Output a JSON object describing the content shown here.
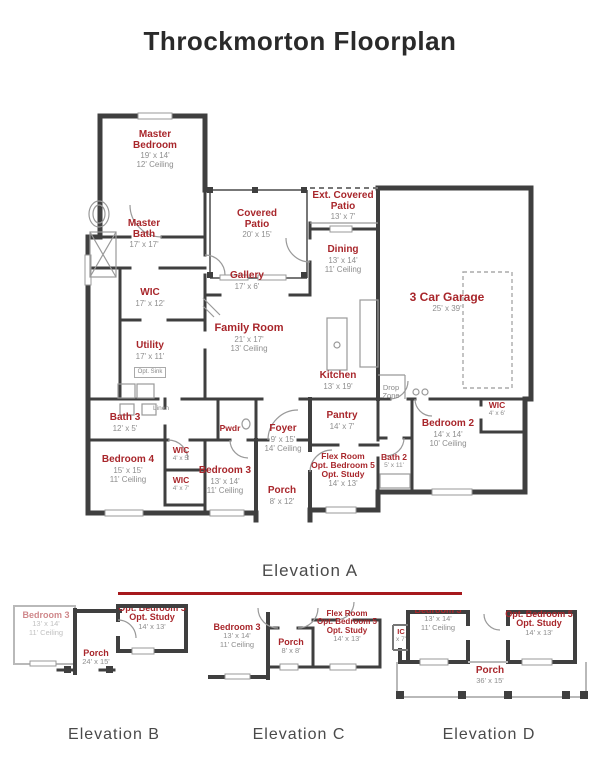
{
  "title": "Throckmorton Floorplan",
  "colors": {
    "room_label": "#a8262b",
    "dim_text": "#8e8e8e",
    "wall": "#3f3f3f",
    "divider_line": "#a6181c"
  },
  "main_plan": {
    "caption": "Elevation A",
    "rooms": {
      "master_bedroom": {
        "name": "Master Bedroom",
        "dims": "19' x 14'",
        "ceiling": "12' Ceiling"
      },
      "master_bath": {
        "name": "Master Bath",
        "dims": "17' x 17'"
      },
      "covered_patio": {
        "name": "Covered Patio",
        "dims": "20' x 15'"
      },
      "ext_covered_patio": {
        "name": "Ext. Covered Patio",
        "dims": "13' x 7'"
      },
      "dining": {
        "name": "Dining",
        "dims": "13' x 14'",
        "ceiling": "11' Ceiling"
      },
      "garage": {
        "name": "3 Car Garage",
        "dims": "25' x 39'"
      },
      "gallery": {
        "name": "Gallery",
        "dims": "17' x 6'"
      },
      "wic_master": {
        "name": "WIC",
        "dims": "17' x 12'"
      },
      "family_room": {
        "name": "Family Room",
        "dims": "21' x 17'",
        "ceiling": "13' Ceiling"
      },
      "utility": {
        "name": "Utility",
        "dims": "17' x 11'",
        "note": "Opt. Sink"
      },
      "kitchen": {
        "name": "Kitchen",
        "dims": "13' x 19'"
      },
      "drop_zone": {
        "name": "Drop Zone"
      },
      "pantry": {
        "name": "Pantry",
        "dims": "14' x 7'"
      },
      "bath_3": {
        "name": "Bath 3",
        "dims": "12' x 5'"
      },
      "pwdr": {
        "name": "Pwdr"
      },
      "foyer": {
        "name": "Foyer",
        "dims": "9' x 15'",
        "ceiling": "14' Ceiling"
      },
      "bedroom_2": {
        "name": "Bedroom 2",
        "dims": "14' x 14'",
        "ceiling": "10' Ceiling"
      },
      "wic_bedroom_2": {
        "name": "WIC",
        "dims": "4' x 6'"
      },
      "bedroom_4": {
        "name": "Bedroom 4",
        "dims": "15' x 15'",
        "ceiling": "11' Ceiling"
      },
      "wic_hall_upper": {
        "name": "WIC",
        "dims": "4' x 5'"
      },
      "wic_hall_lower": {
        "name": "WIC",
        "dims": "4' x 7'"
      },
      "bedroom_3": {
        "name": "Bedroom 3",
        "dims": "13' x 14'",
        "ceiling": "11' Ceiling"
      },
      "porch": {
        "name": "Porch",
        "dims": "8' x 12'"
      },
      "flex_room": {
        "name": "Flex Room",
        "name2": "Opt. Bedroom 5",
        "name3": "Opt. Study",
        "dims": "14' x 13'"
      },
      "bath_2": {
        "name": "Bath 2",
        "dims": "5' x 11'"
      },
      "linen": {
        "name": "Linen"
      }
    }
  },
  "elevations": {
    "elev_b": {
      "caption": "Elevation B",
      "rooms": {
        "bedroom_3": {
          "name": "Bedroom 3",
          "dims": "13' x 14'",
          "ceiling": "11' Ceiling"
        },
        "porch": {
          "name": "Porch",
          "dims": "24' x 15'"
        },
        "opt_bedroom_5": {
          "name": "Opt. Bedroom 5",
          "name2": "Opt. Study",
          "dims": "14' x 13'"
        }
      }
    },
    "elev_c": {
      "caption": "Elevation C",
      "rooms": {
        "bedroom_3": {
          "name": "Bedroom 3",
          "dims": "13' x 14'",
          "ceiling": "11' Ceiling"
        },
        "porch": {
          "name": "Porch",
          "dims": "8' x 8'"
        },
        "flex_room": {
          "name": "Flex Room",
          "name2": "Opt. Bedroom 5",
          "name3": "Opt. Study",
          "dims": "14' x 13'"
        }
      }
    },
    "elev_d": {
      "caption": "Elevation D",
      "rooms": {
        "bedroom_3": {
          "name": "Bedroom 3",
          "dims": "13' x 14'",
          "ceiling": "11' Ceiling"
        },
        "wic_partial": {
          "name": "IC",
          "dims": "x 7'"
        },
        "opt_bedroom_5": {
          "name": "Opt. Bedroom 5",
          "name2": "Opt. Study",
          "dims": "14' x 13'"
        },
        "porch": {
          "name": "Porch",
          "dims": "36' x 15'"
        }
      }
    }
  }
}
